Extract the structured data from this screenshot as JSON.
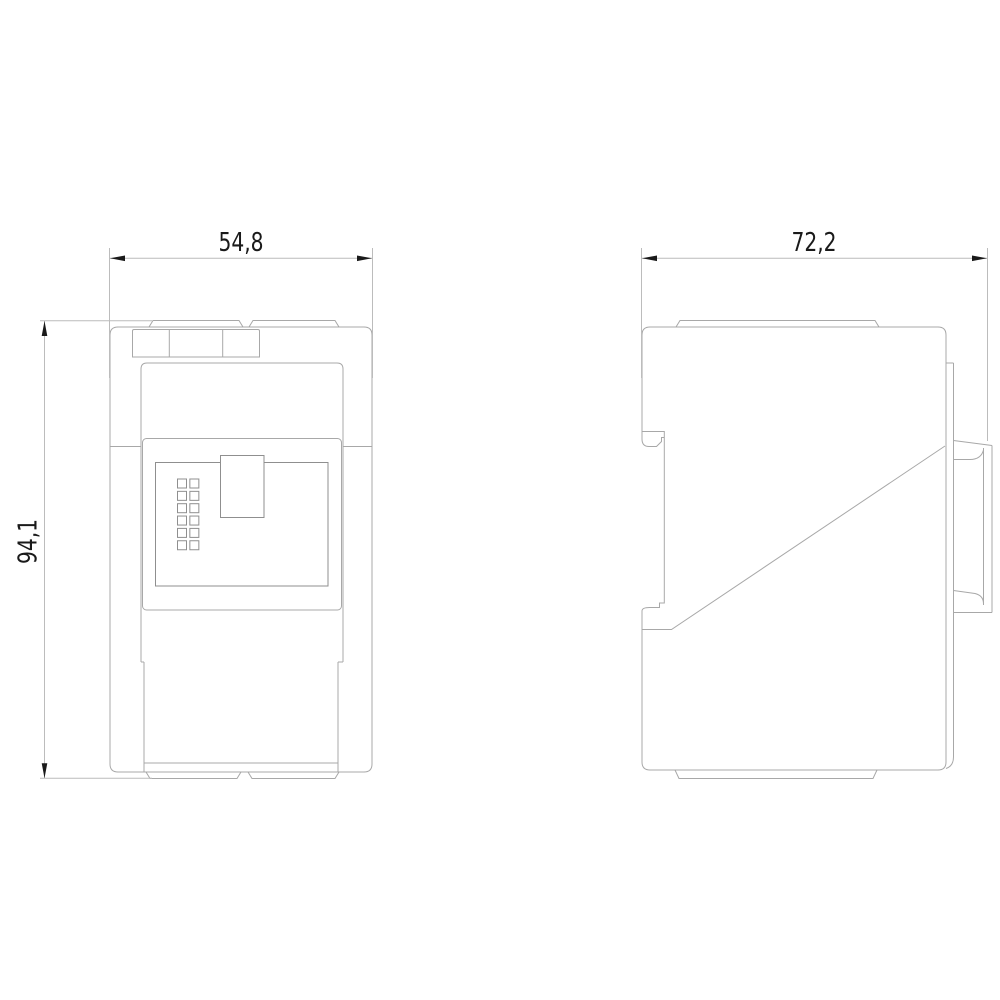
{
  "drawing": {
    "type": "technical-dimension-drawing",
    "background_color": "#ffffff",
    "part_line_color": "#a8a8a8",
    "dimension_line_color": "#bcbcbc",
    "dimension_text_color": "#1a1a1a",
    "front_view": {
      "width_dimension": "54,8",
      "height_dimension": "94,1",
      "led_grid": {
        "columns": 2,
        "rows": 6,
        "x": 177.5,
        "y": 479,
        "size": 9,
        "pitch": 12.35
      }
    },
    "side_view": {
      "width_dimension": "72,2"
    }
  }
}
